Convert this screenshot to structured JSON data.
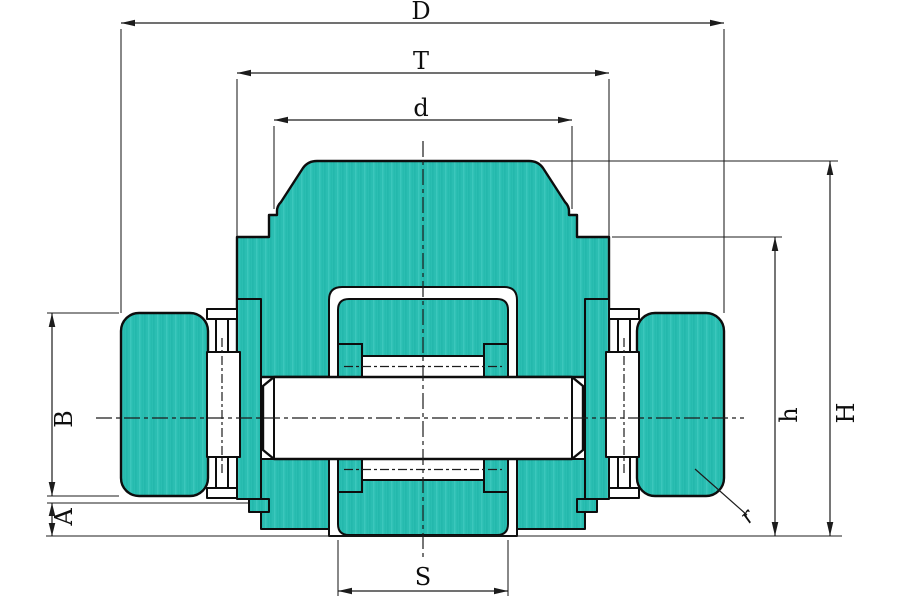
{
  "drawing": {
    "kind": "bearing-assembly-cross-section",
    "labels": {
      "D": "D",
      "T": "T",
      "d": "d",
      "B": "B",
      "A": "A",
      "S": "S",
      "h": "h",
      "H": "H",
      "r": "r"
    },
    "colors": {
      "part_fill": "#2bbeb2",
      "part_fill_shade": "#17b0a4",
      "part_fill_light": "#48cfc4",
      "outline": "#0d0d0d",
      "dim_line": "#1c1c1c",
      "background": "#ffffff"
    }
  }
}
